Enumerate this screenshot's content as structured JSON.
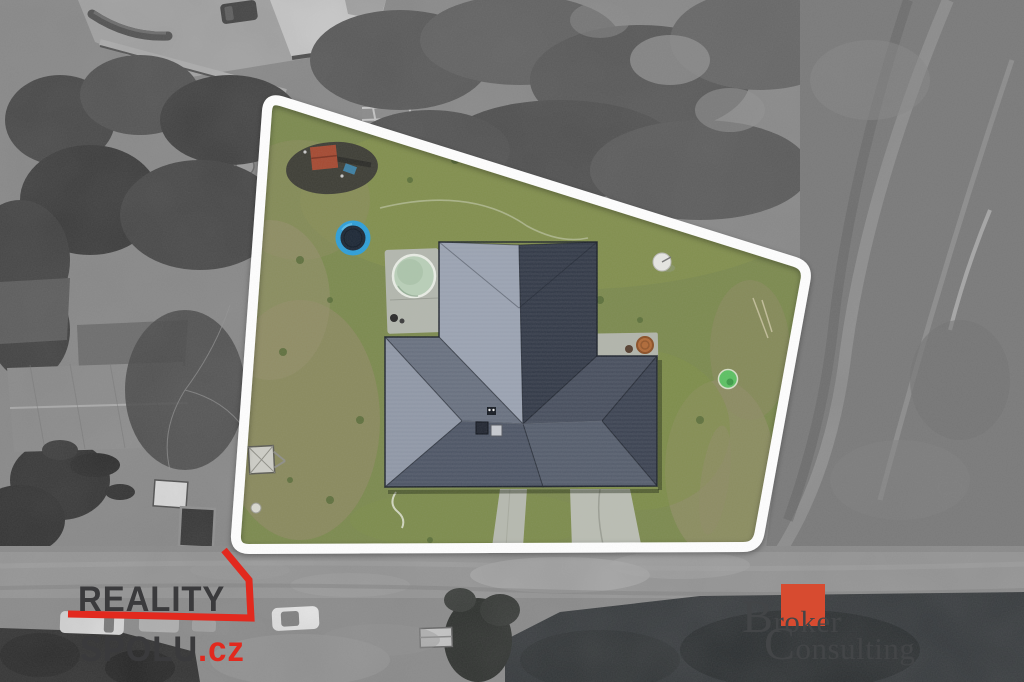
{
  "watermarks": {
    "reality_spolu": {
      "line1": "REALITY",
      "line2": "SPOLU",
      "suffix": ".cz",
      "text_color": "#3a3a3c",
      "accent_color": "#e2291e"
    },
    "broker_consulting": {
      "word1": "Broker",
      "registered": "®",
      "word2": "Consulting",
      "text_color": "#434547",
      "square_color": "#d74b30"
    }
  },
  "scene": {
    "type": "aerial-drone-photo-of-property",
    "highlight_style": "color-inside-white-boundary, grayscale-outside",
    "palette": {
      "boundary": "#ffffff",
      "lawn": "#7c8a4f",
      "roof_dark": "#323947",
      "roof_light": "#9aa2b1",
      "road_gray": "#8e8e8e",
      "field_gray": "#7b7b7b",
      "trampoline_blue": "#2f9fd8",
      "pool_water": "#b9cfb8",
      "playground_roof": "#a54a32",
      "dark_water": "#33373a"
    },
    "objects": [
      "house-hip-roof",
      "trampoline",
      "round-pool-on-pad",
      "playground-set",
      "terrace-pad-with-hose-reel",
      "satellite-dish",
      "green-kiddie-pool",
      "utility-trailer",
      "two-driveways",
      "road-with-parked-cars",
      "barn",
      "field-with-track-arcs",
      "trees"
    ]
  }
}
